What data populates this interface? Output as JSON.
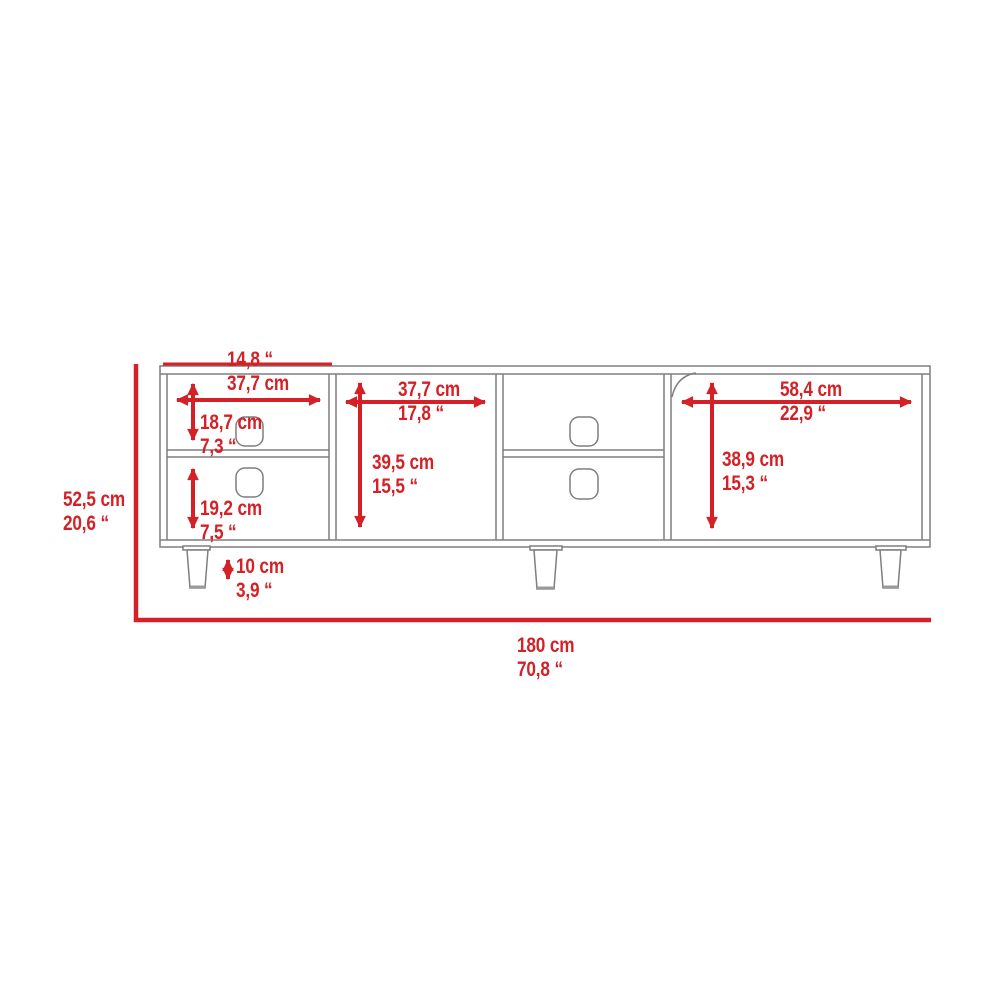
{
  "diagram_type": "furniture-dimension-diagram",
  "colors": {
    "red": "#d42127",
    "line": "#7e7e7e"
  },
  "dims": {
    "comp1_width": {
      "line1": "14,8 “",
      "line2": "37,7 cm"
    },
    "comp1_top_height": {
      "line1": "18,7 cm",
      "line2": "7,3 “"
    },
    "comp1_bot_height": {
      "line1": "19,2 cm",
      "line2": "7,5 “"
    },
    "comp2_width": {
      "line1": "37,7 cm",
      "line2": "17,8 “"
    },
    "comp2_height": {
      "line1": "39,5 cm",
      "line2": "15,5 “"
    },
    "comp4_width": {
      "line1": "58,4 cm",
      "line2": "22,9 “"
    },
    "comp4_height": {
      "line1": "38,9 cm",
      "line2": "15,3 “"
    },
    "leg_height": {
      "line1": "10 cm",
      "line2": "3,9 “"
    },
    "overall_height": {
      "line1": "52,5 cm",
      "line2": "20,6 “"
    },
    "overall_width": {
      "line1": "180 cm",
      "line2": "70,8 “"
    }
  }
}
